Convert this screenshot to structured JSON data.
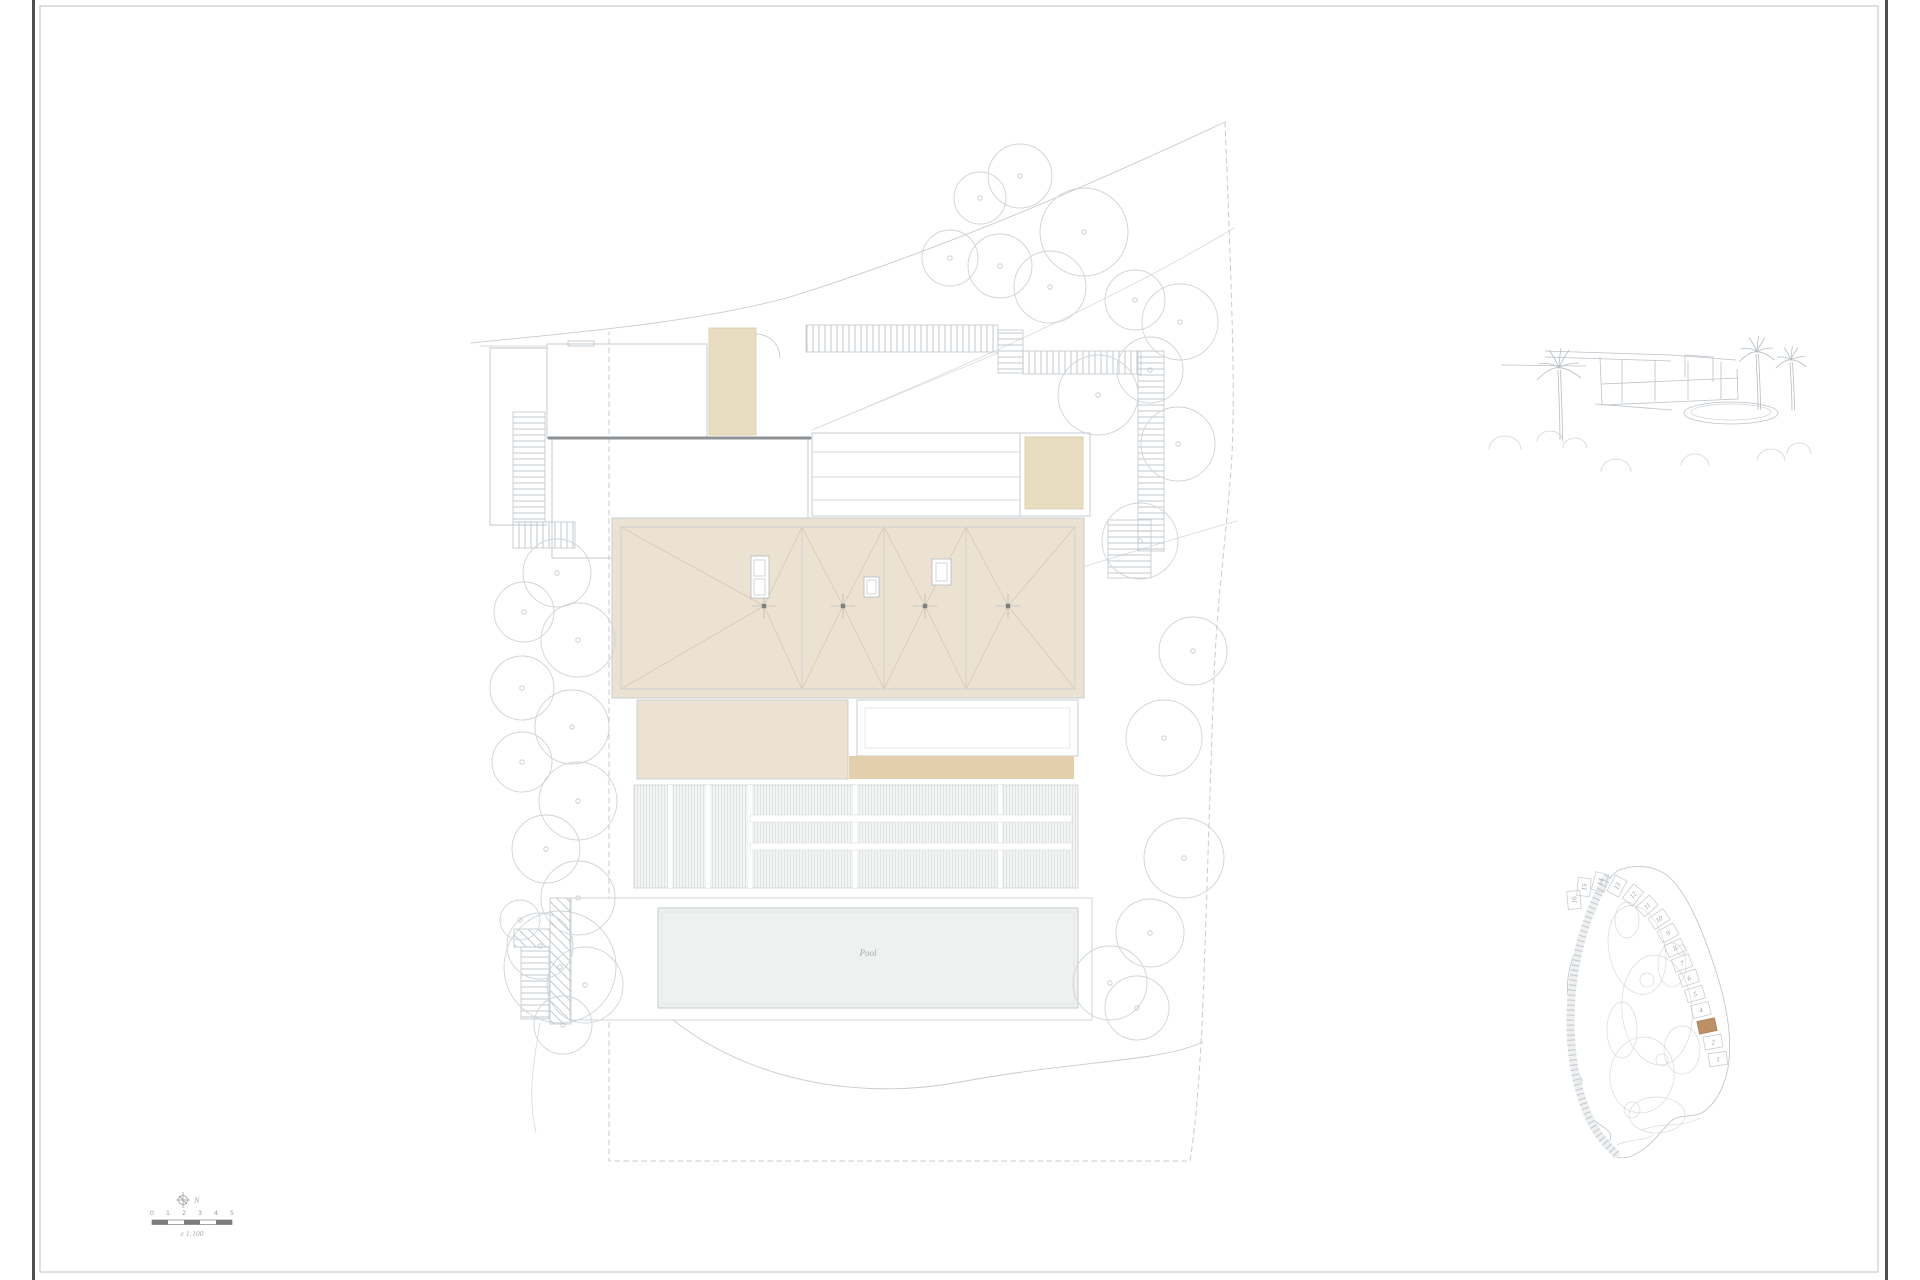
{
  "sheet": {
    "palette": {
      "paper": "#ffffff",
      "line": "#c0c7cc",
      "line_soft": "#d6dadd",
      "wall_dark": "#8e9194",
      "edge_dark": "#4d4f52",
      "frame": "#c9cdd0",
      "roof_fill": "#ece2d1",
      "tan_fill": "#e3cfab",
      "deck_fill": "#f3f4f4",
      "pool_fill": "#eff1f0",
      "lot_highlight": "#bd9066",
      "text_gray": "#9aa0a5"
    }
  },
  "site_plan": {
    "pool_label": "Pool"
  },
  "compass": {
    "label": "N"
  },
  "scale_bar": {
    "tick_labels": [
      "0",
      "1",
      "2",
      "3",
      "4",
      "5"
    ],
    "caption": "e 1:100"
  },
  "key_map": {
    "visible_lot_numbers": [
      "1",
      "2",
      "4",
      "5",
      "6",
      "7",
      "8",
      "9",
      "10",
      "11",
      "12",
      "13",
      "14",
      "15",
      "16"
    ]
  }
}
